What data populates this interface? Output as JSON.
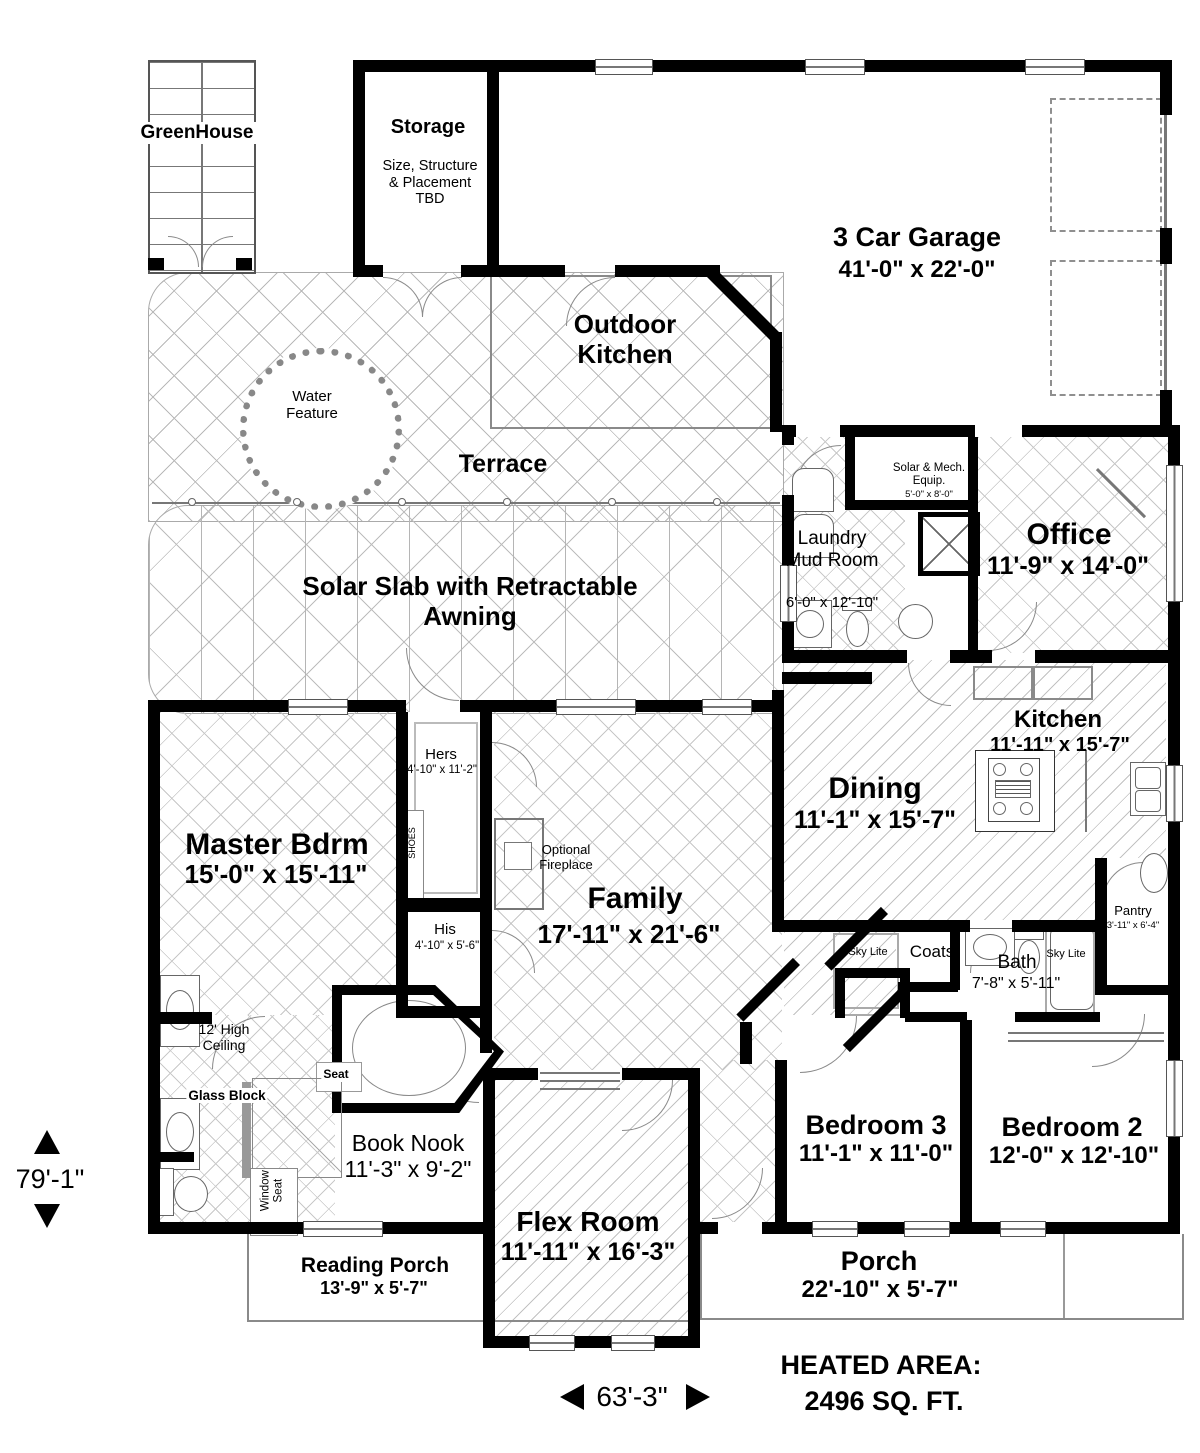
{
  "rooms": {
    "greenhouse": {
      "name": "GreenHouse"
    },
    "storage": {
      "name": "Storage",
      "note": "Size, Structure & Placement TBD"
    },
    "garage": {
      "name": "3 Car Garage",
      "dims": "41'-0\" x 22'-0\""
    },
    "outdoor_kitchen": {
      "name": "Outdoor Kitchen"
    },
    "water_feature": {
      "name": "Water Feature"
    },
    "terrace": {
      "name": "Terrace"
    },
    "solar_slab": {
      "name": "Solar Slab with Retractable Awning"
    },
    "laundry": {
      "name": "Laundry Mud Room",
      "dims": "6'-0\" x 12'-10\""
    },
    "solar_mech": {
      "name": "Solar & Mech. Equip.",
      "dims": "5'-0\" x 8'-0\""
    },
    "office": {
      "name": "Office",
      "dims": "11'-9\" x 14'-0\""
    },
    "kitchen": {
      "name": "Kitchen",
      "dims": "11'-11\" x 15'-7\""
    },
    "dining": {
      "name": "Dining",
      "dims": "11'-1\" x 15'-7\""
    },
    "master": {
      "name": "Master Bdrm",
      "dims": "15'-0\" x 15'-11\""
    },
    "hers": {
      "name": "Hers",
      "dims": "4'-10\" x 11'-2\""
    },
    "his": {
      "name": "His",
      "dims": "4'-10\" x 5'-6\""
    },
    "shoes": {
      "name": "SHOES"
    },
    "family": {
      "name": "Family",
      "dims": "17'-11\" x 21'-6\""
    },
    "fireplace": {
      "name": "Optional Fireplace"
    },
    "coats": {
      "name": "Coats"
    },
    "bath": {
      "name": "Bath",
      "dims": "7'-8\" x 5'-11\""
    },
    "pantry": {
      "name": "Pantry",
      "dims": "3'-11\" x 6'-4\""
    },
    "bedroom3": {
      "name": "Bedroom 3",
      "dims": "11'-1\" x 11'-0\""
    },
    "bedroom2": {
      "name": "Bedroom 2",
      "dims": "12'-0\" x 12'-10\""
    },
    "book_nook": {
      "name": "Book Nook",
      "dims": "11'-3\" x 9'-2\""
    },
    "reading_porch": {
      "name": "Reading Porch",
      "dims": "13'-9\" x 5'-7\""
    },
    "flex": {
      "name": "Flex Room",
      "dims": "11'-11\" x 16'-3\""
    },
    "porch": {
      "name": "Porch",
      "dims": "22'-10\" x 5'-7\""
    }
  },
  "annotations": {
    "sky_lite_left": "Sky Lite",
    "sky_lite_right": "Sky Lite",
    "high_ceiling": "12' High Ceiling",
    "glass_block": "Glass Block",
    "seat": "Seat",
    "window_seat": "Window Seat"
  },
  "dimensions": {
    "vertical": "79'-1\"",
    "horizontal": "63'-3\"",
    "heated_line1": "HEATED AREA:",
    "heated_line2": "2496 SQ. FT."
  }
}
